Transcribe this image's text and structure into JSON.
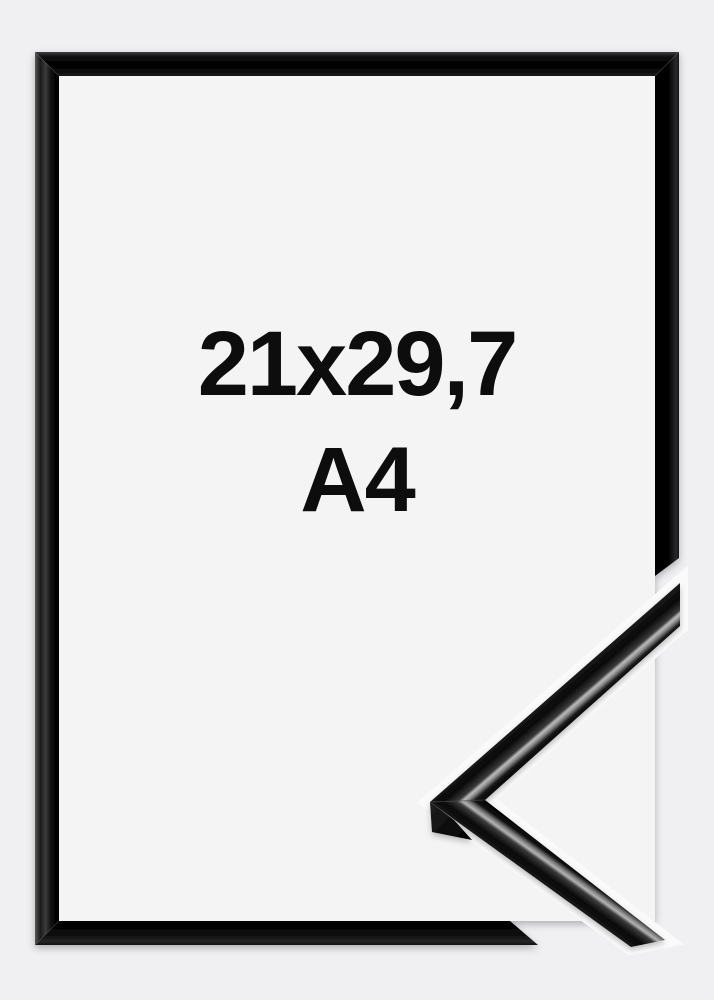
{
  "product_image": {
    "size_label": "21x29,7",
    "format_label": "A4",
    "frame_style": "black-glossy",
    "elements": {
      "frame": "picture-frame",
      "corner_sample": "frame-corner-profile"
    }
  },
  "colors": {
    "background": "#f0f0f2",
    "frame_interior": "#f4f4f5",
    "frame_black": "#0a0a0a",
    "gloss_highlight": "#bbbbbb",
    "text": "#0d0d0d",
    "gap_outline": "#fafafb"
  }
}
